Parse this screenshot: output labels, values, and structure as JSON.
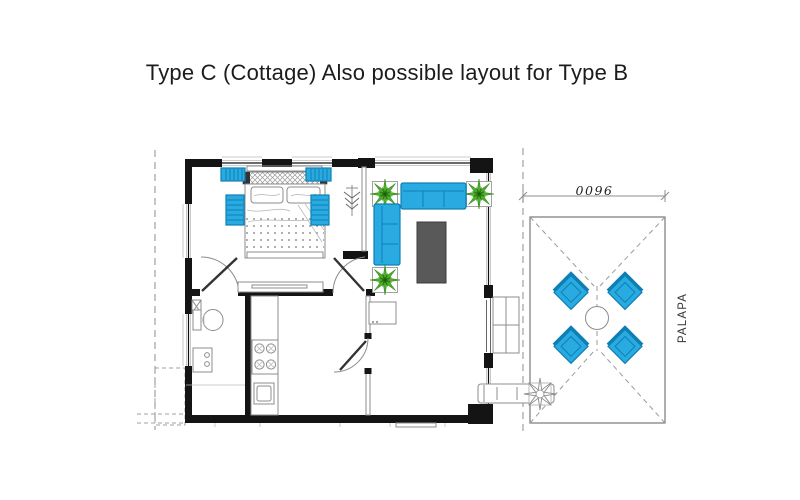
{
  "title": "Type C (Cottage) Also possible layout for Type B",
  "palapa": {
    "label": "PALAPA",
    "dimension_label": "9600",
    "chair_count": 4
  },
  "plan": {
    "indoor_plant_count": 3,
    "bedside_mat_count": 4
  },
  "colors": {
    "title_color": "#1c1c1c",
    "wall_black": "#141414",
    "line_gray": "#8c8c8c",
    "dash_gray": "#a0a0a0",
    "furniture_blue": "#29ABE2",
    "furniture_blue_dark": "#0d7fb3",
    "plant_green": "#4caf28",
    "plant_green_dark": "#2e7d14",
    "table_gray": "#595959"
  }
}
